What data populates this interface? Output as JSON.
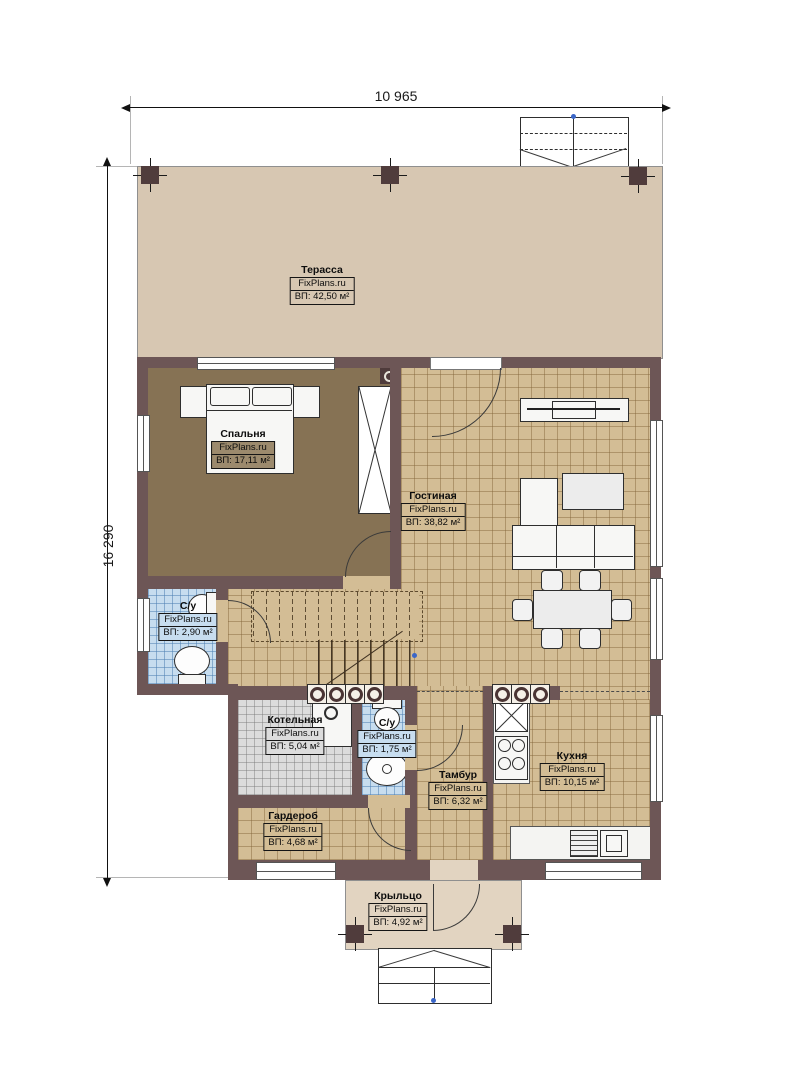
{
  "dimensions": {
    "top": "10 965",
    "left": "16 290"
  },
  "rooms": [
    {
      "name": "Терасса",
      "site": "FixPlans.ru",
      "area": "ВП: 42,50 м²"
    },
    {
      "name": "Спальня",
      "site": "FixPlans.ru",
      "area": "ВП: 17,11 м²"
    },
    {
      "name": "Гостиная",
      "site": "FixPlans.ru",
      "area": "ВП: 38,82 м²"
    },
    {
      "name": "С/у",
      "site": "FixPlans.ru",
      "area": "ВП: 2,90 м²"
    },
    {
      "name": "Котельная",
      "site": "FixPlans.ru",
      "area": "ВП: 5,04 м²"
    },
    {
      "name": "С/у",
      "site": "FixPlans.ru",
      "area": "ВП: 1,75 м²"
    },
    {
      "name": "Тамбур",
      "site": "FixPlans.ru",
      "area": "ВП: 6,32 м²"
    },
    {
      "name": "Кухня",
      "site": "FixPlans.ru",
      "area": "ВП: 10,15 м²"
    },
    {
      "name": "Гардероб",
      "site": "FixPlans.ru",
      "area": "ВП: 4,68 м²"
    },
    {
      "name": "Крыльцо",
      "site": "FixPlans.ru",
      "area": "ВП: 4,92 м²"
    }
  ],
  "colors": {
    "wall": "#6d5656",
    "terrace_floor": "#d7c7b2",
    "porch_floor": "#e2d4c1",
    "bedroom_floor": "#867254",
    "tile_tan": "#d3bd95",
    "tile_blue": "#c7ddef",
    "tile_grey": "#dcdcdc",
    "marker_blue": "#3a66c8"
  }
}
